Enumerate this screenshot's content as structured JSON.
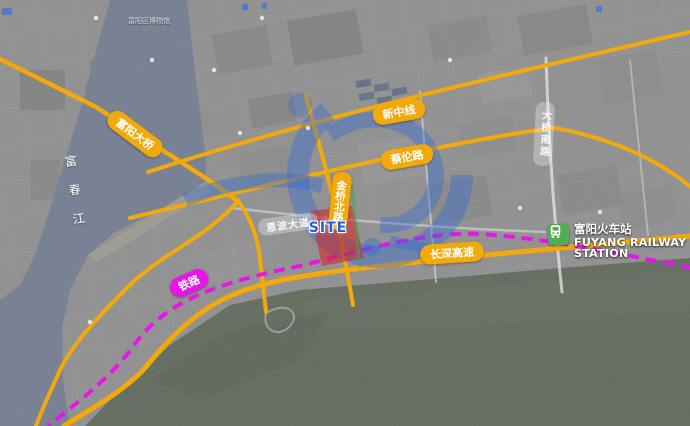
{
  "title": "Fuyang site location satellite map",
  "colors": {
    "road_yellow": "#F2A90B",
    "railway_magenta": "#E716E7",
    "river_blue": "#5E6E94",
    "mountain_green": "#3C4A33",
    "station_green": "#4FAE51",
    "site_red": "rgba(214,34,34,0.55)",
    "site_text_blue": "#1E63D6",
    "watermark_blue": "rgba(45,105,215,0.38)"
  },
  "labels": {
    "bridge": "富阳大桥",
    "road_xinzhong": "新中线",
    "road_cailun": "蔡伦路",
    "road_jinqiao": "金桥北路",
    "road_daqiao_south": "大桥南路",
    "road_enbo": "恩波大道",
    "expressway": "长深高速",
    "railway": "铁路",
    "river": "富春江",
    "site": "SITE",
    "museum_poi": "富阳区博物馆"
  },
  "station": {
    "name_cn": "富阳火车站",
    "name_en_line1": "FUYANG RAILWAY",
    "name_en_line2": "STATION"
  }
}
